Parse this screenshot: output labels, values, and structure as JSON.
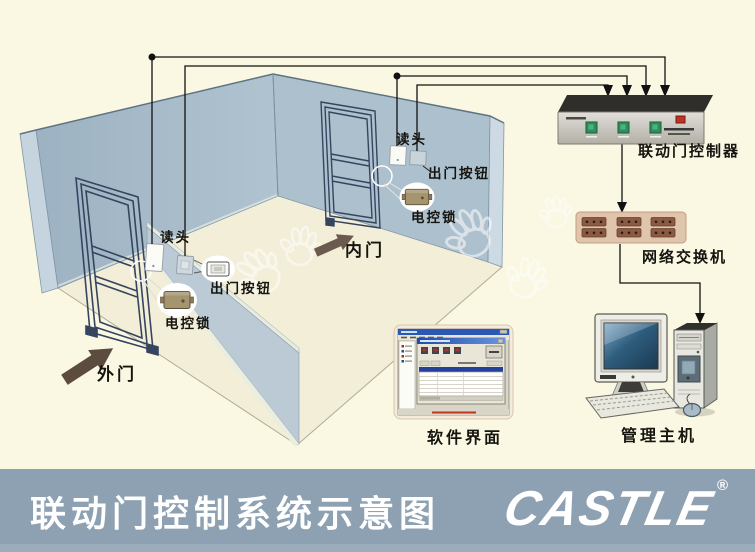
{
  "labels": {
    "outer_door": "外门",
    "inner_door": "内门",
    "outer_reader": "读头",
    "inner_reader": "读头",
    "outer_exit_button": "出门按钮",
    "inner_exit_button": "出门按钮",
    "outer_lock": "电控锁",
    "inner_lock": "电控锁",
    "controller": "联动门控制器",
    "network_switch": "网络交换机",
    "software_ui": "软件界面",
    "management_host": "管理主机"
  },
  "footer": {
    "title": "联动门控制系统示意图",
    "logo_text": "CASTLE",
    "registered_mark": "®",
    "band_color": "#8EA1B2"
  },
  "devices": {
    "controller_led_count": 3,
    "switch_port_count": 6
  },
  "colors": {
    "background": "#FAF8E2",
    "wall": "#A7BBCA",
    "wall_light": "#C6D4DF",
    "partition_wall": "#BCCAD6",
    "floor": "#F2EED8",
    "wire": "#111111",
    "door_frame": "#36455F",
    "led_green": "#2E8F5E",
    "led_red": "#C23222",
    "switch_body": "#E0C5AD",
    "switch_port": "#8A5A42",
    "direction_arrow": "#5C4C40",
    "monitor_screen": "#2E5D7D",
    "band": "#8EA1B2"
  }
}
